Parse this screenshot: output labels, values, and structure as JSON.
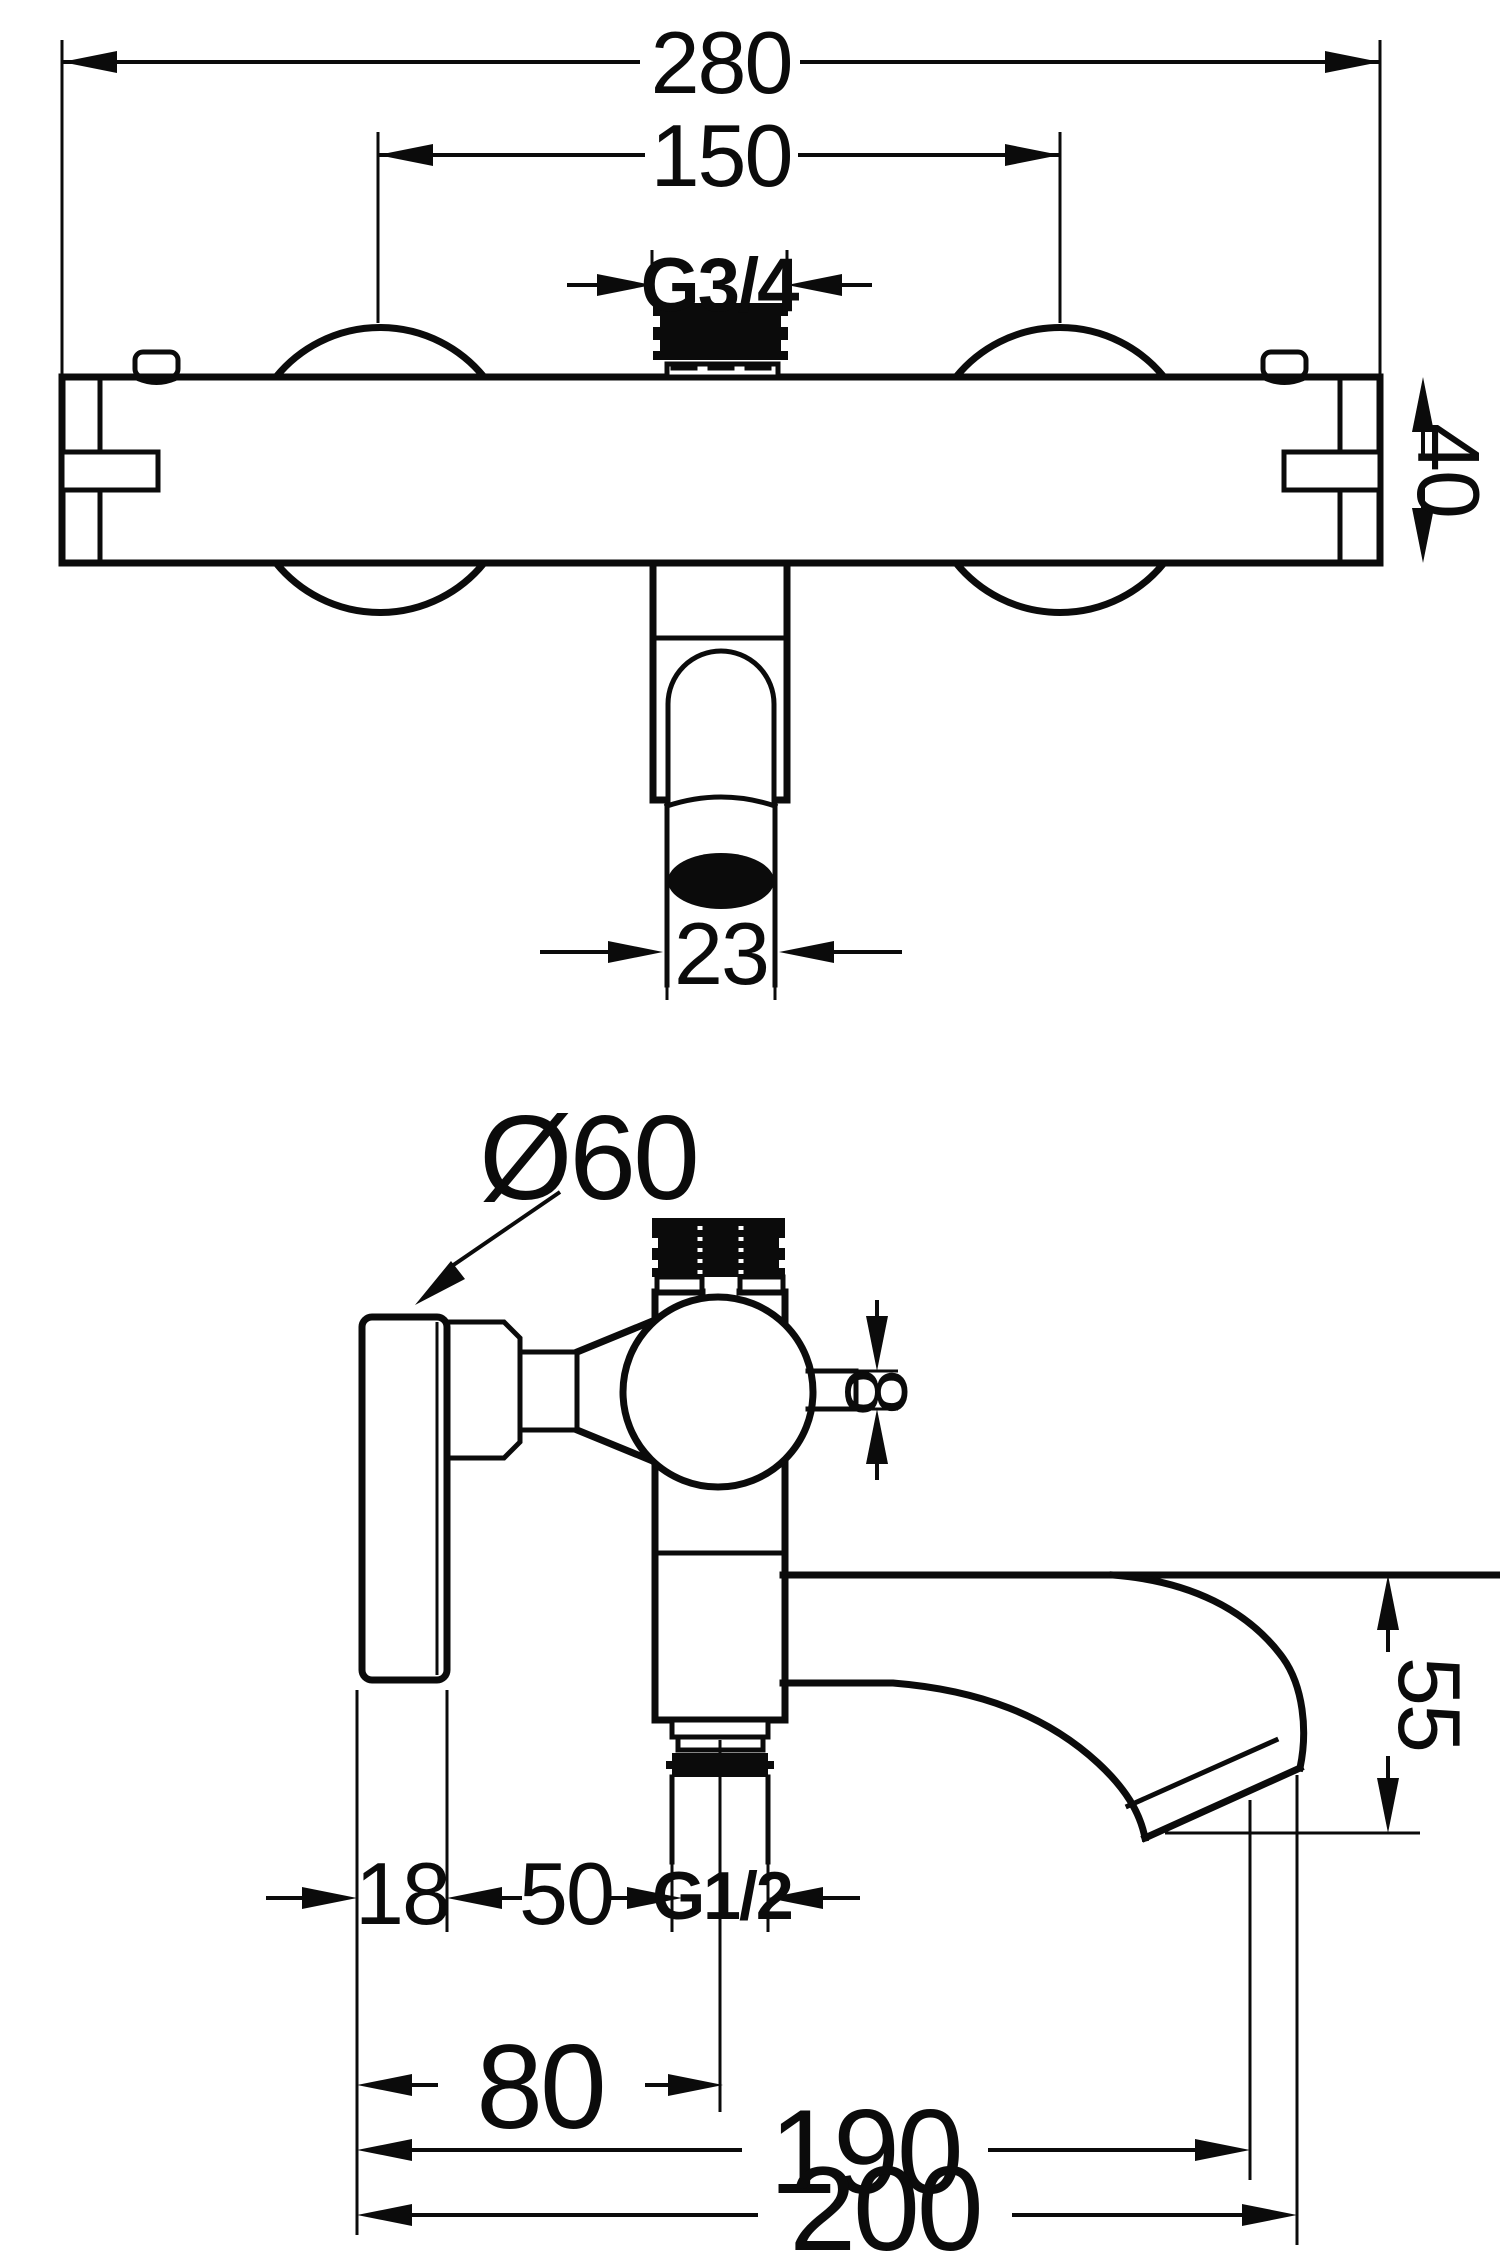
{
  "drawing": {
    "type": "technical-dimension-diagram",
    "subject": "wall-mounted thermostatic bath-shower mixer faucet, front and side projections",
    "colors": {
      "line": "#0b0b0b",
      "background": "#ffffff"
    },
    "front_view": {
      "labels": {
        "overall_width": "280",
        "handle_centers_width": "150",
        "top_thread": "G3/4",
        "body_height": "40",
        "outlet_diameter": "23"
      }
    },
    "side_view": {
      "labels": {
        "wall_plate_diameter": "Ø60",
        "stub_height": "8",
        "spout_drop": "55",
        "plate_depth": "18",
        "plate_to_thread": "50",
        "bottom_thread": "G1/2",
        "wall_to_outlet_axis": "80",
        "wall_to_spout_inner": "190",
        "wall_to_spout_tip": "200"
      }
    }
  }
}
